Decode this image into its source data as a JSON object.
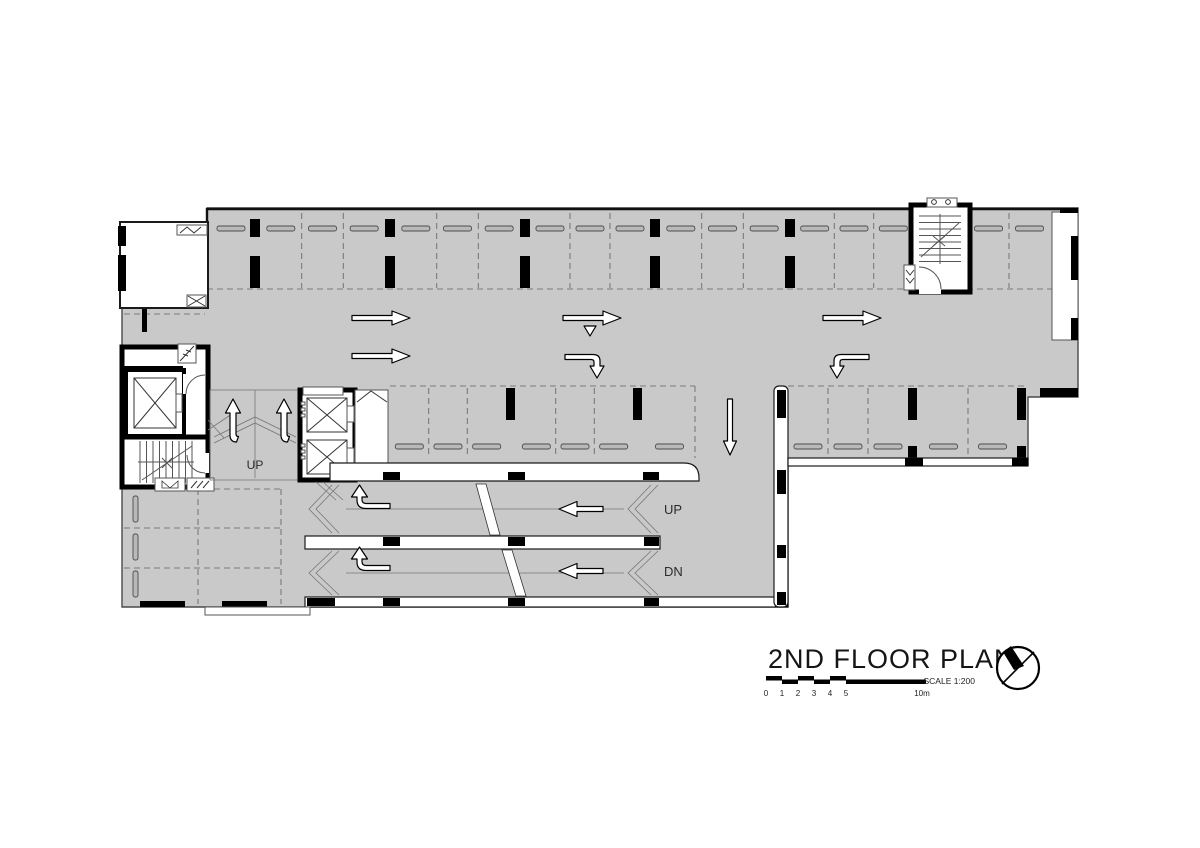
{
  "title_block": {
    "title": "2ND FLOOR PLAN",
    "scale_label": "SCALE 1:200",
    "scale_ticks": [
      "0",
      "1",
      "2",
      "3",
      "4",
      "5"
    ],
    "scale_max_label": "10m"
  },
  "plan_labels": {
    "entry_ramp_up": "UP",
    "ramp_up": "UP",
    "ramp_down": "DN"
  },
  "colors": {
    "floor_gray": "#c9c9c9",
    "wall_black": "#000000",
    "dash_gray": "#7a7a7a",
    "paper_white": "#ffffff"
  }
}
